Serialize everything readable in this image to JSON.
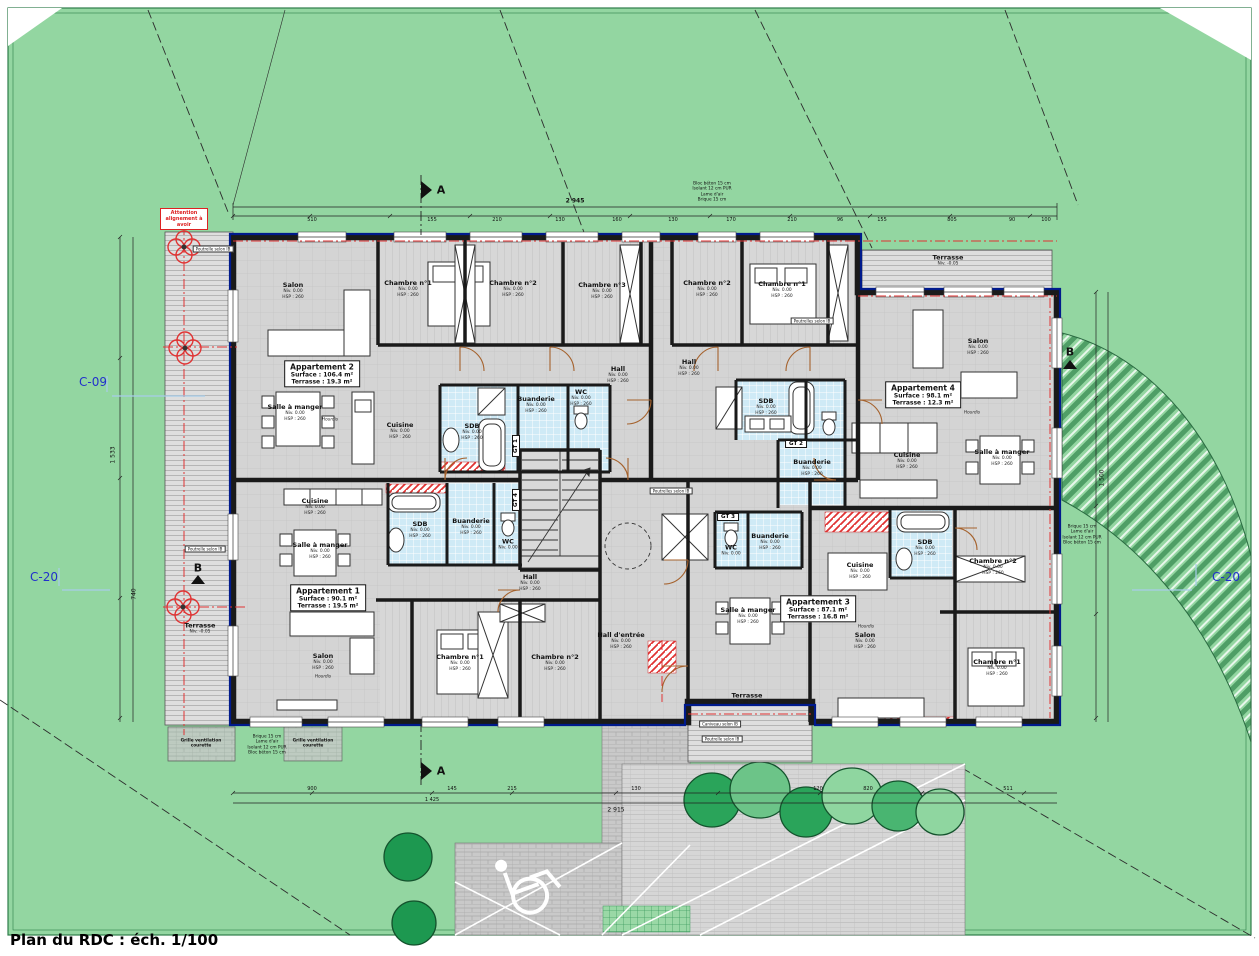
{
  "title": "Plan du RDC : éch. 1/100",
  "markers": {
    "c09": "C-09",
    "c20": "C-20",
    "a": "A",
    "b": "B",
    "warning": "Attention alignement à avoir"
  },
  "apartments": {
    "apt1": {
      "name": "Appartement 1",
      "surface": "Surface : 90.1 m²",
      "terrace": "Terrasse : 19.5 m²"
    },
    "apt2": {
      "name": "Appartement 2",
      "surface": "Surface : 106.4 m²",
      "terrace": "Terrasse : 19.3 m²"
    },
    "apt3": {
      "name": "Appartement 3",
      "surface": "Surface : 87.1 m²",
      "terrace": "Terrasse : 16.8 m²"
    },
    "apt4": {
      "name": "Appartement 4",
      "surface": "Surface : 98.1 m²",
      "terrace": "Terrasse : 12.3 m²"
    }
  },
  "rooms": {
    "salon": "Salon",
    "chambre1": "Chambre n°1",
    "chambre2": "Chambre n°2",
    "chambre3": "Chambre n°3",
    "cuisine": "Cuisine",
    "salle_a_manger": "Salle à manger",
    "sdb": "SDB",
    "wc": "WC",
    "buanderie": "Buanderie",
    "hall": "Hall",
    "hall_entree": "Hall d'entrée",
    "terrasse": "Terrasse"
  },
  "levels": {
    "niv": "Niv. 0.00",
    "hsp": "HSP : 260",
    "niv_terrasse": "Niv. -0.05"
  },
  "gt": {
    "gt1": "GT 1",
    "gt2": "GT 2",
    "gt3": "GT 3",
    "gt4": "GT 4"
  },
  "notes": {
    "grille": "Grille ventilation courette",
    "poutrelle": "Poutrelle selon IB",
    "poutrelles": "Poutrelles selon IB",
    "caniveau": "Caniveau selon IB",
    "hourdis": "Hourdis",
    "wall_comp": [
      "Brique 15 cm",
      "Lame d'air",
      "Isolant 12 cm PUR",
      "Bloc béton 15 cm"
    ],
    "wall_comp_rev": [
      "Bloc béton 15 cm",
      "Isolant 12 cm PUR",
      "Lame d'air",
      "Brique 15 cm"
    ]
  },
  "dims": {
    "top_overall": "2 945",
    "bottom_overall": "2 915",
    "left_1": "1 533",
    "left_2": "740",
    "right_1": "1 500",
    "top_segs": [
      "510",
      "155",
      "210",
      "130",
      "160",
      "130",
      "170",
      "210",
      "96",
      "155",
      "805",
      "90",
      "100"
    ],
    "bottom_segs": [
      "900",
      "145",
      "215",
      "1 425",
      "130",
      "120",
      "820",
      "511"
    ]
  },
  "colors": {
    "site_green": "#93d6a1",
    "building_gray": "#d4d4d4",
    "wall_dark": "#1a1a1a",
    "insulation_blue": "#001a8c",
    "axis_red": "#e03333",
    "bath_blue": "#cfeaf6",
    "section_blue": "#2230cc",
    "tree_green": "#1d9850"
  }
}
